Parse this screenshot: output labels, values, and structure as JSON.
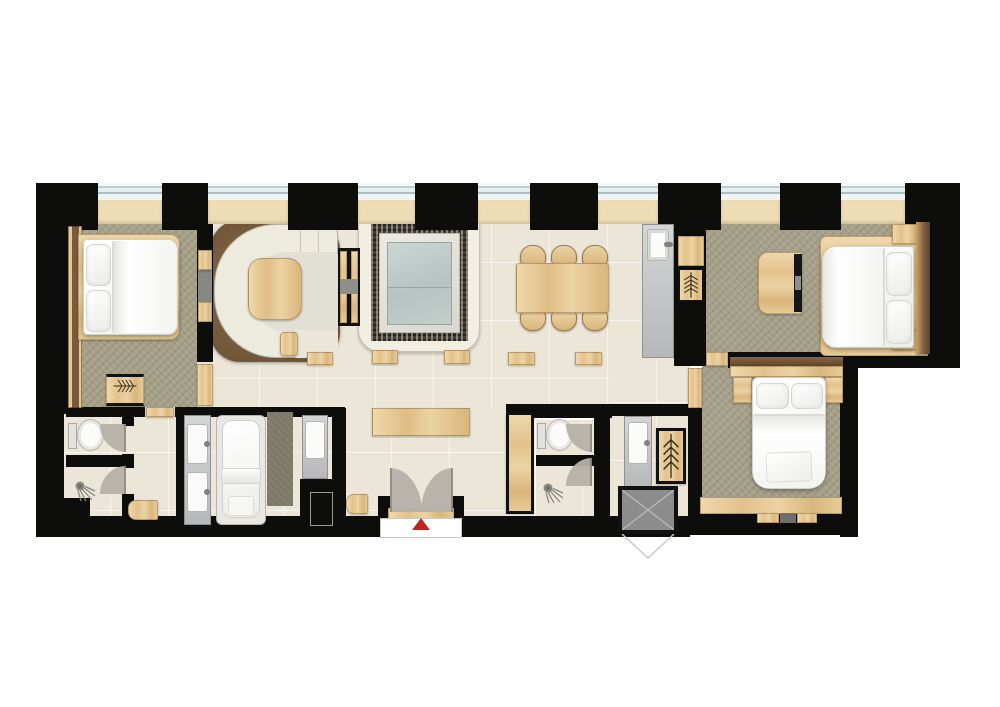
{
  "app": {
    "name": "apartment-floor-plan",
    "view": "architectural-top-down"
  },
  "palette": {
    "wall": "#0d0d0c",
    "tile": "#ece6d8",
    "carpet": "#a6a089",
    "bath_mat": "#7d7867",
    "wood_light": "#ecd5a6",
    "wood_dark": "#7a5a3c",
    "sofa_cream": "#edeade",
    "sofa_inner": "#e2dfd4",
    "rug_brown": "#7b5f42",
    "counter_gray": "#c6c8ca",
    "fixture_white": "#fbfbf9",
    "glass_blue": "#c0cbc8",
    "mosaic_dark": "#413e37",
    "marble_light": "#e7e5de",
    "door_swing": "#b6b2a9",
    "glazing": "#e7edee",
    "shaft_gray": "#8c8c8c",
    "entry_marker_red": "#c3231f"
  },
  "plan": {
    "entrance": {
      "marker": "red-triangle-arrow",
      "doors": "double-swing",
      "mat": "white-doormat"
    },
    "windows": {
      "count": 7,
      "location": "north-wall"
    },
    "rooms": [
      {
        "id": "bedroom-west",
        "floor": "carpet",
        "items": [
          "double-bed",
          "wardrobe-strip",
          "hanger-rack"
        ]
      },
      {
        "id": "living-lounge",
        "floor": "tile",
        "items": [
          "curved-sectional-sofa",
          "coffee-table",
          "area-rug",
          "media-divider"
        ]
      },
      {
        "id": "central-hall",
        "floor": "tile",
        "items": [
          "framed-spa-pool",
          "steps",
          "benches",
          "console-table"
        ]
      },
      {
        "id": "dining-area",
        "floor": "tile",
        "items": [
          "dining-table",
          "chairs-x6"
        ]
      },
      {
        "id": "kitchenette",
        "floor": "tile",
        "items": [
          "counter-with-sink"
        ]
      },
      {
        "id": "bedroom-east",
        "floor": "carpet",
        "items": [
          "double-bed",
          "dresser",
          "hanger-rack",
          "bench"
        ]
      },
      {
        "id": "bedroom-south",
        "floor": "carpet",
        "items": [
          "double-bed",
          "hanger-rack",
          "bench"
        ]
      },
      {
        "id": "bathroom-west",
        "floor": "tile",
        "items": [
          "toilet",
          "shower",
          "double-vanity",
          "bathtub",
          "vanity",
          "mat"
        ]
      },
      {
        "id": "wc-east",
        "floor": "tile",
        "items": [
          "toilet",
          "shower",
          "vanity",
          "tall-cabinet",
          "wardrobe",
          "service-shaft"
        ]
      }
    ]
  }
}
